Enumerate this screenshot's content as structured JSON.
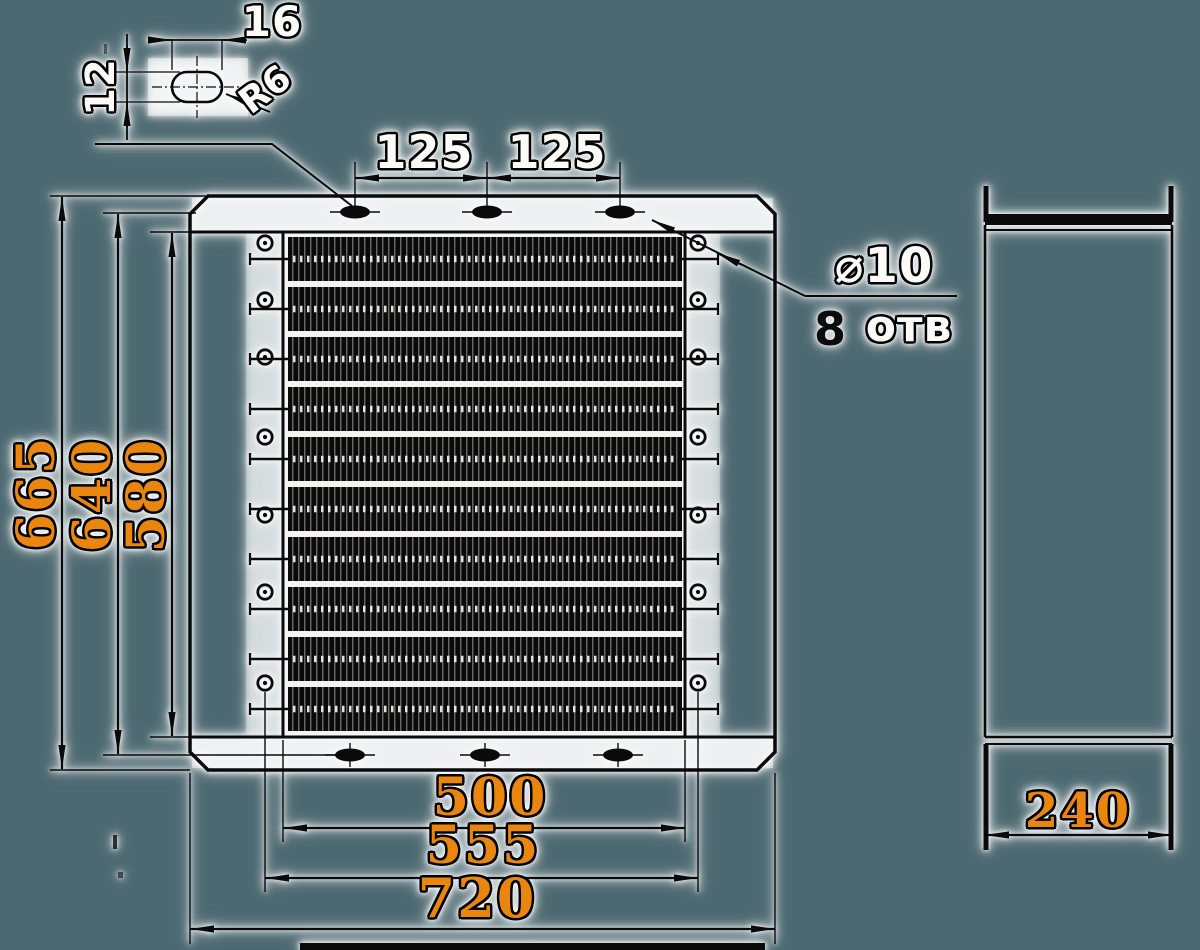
{
  "drawing_title": "finned-element heater frame, two-view dimensioned drawing",
  "colors": {
    "background": "#4c6870",
    "ink": "#0a0a0a",
    "accent_orange": "#ea860d",
    "paper_halo": "#f7f7f4"
  },
  "detail_slot": {
    "width": "16",
    "height": "12",
    "radius": "R6"
  },
  "top_pitch": {
    "left": "125",
    "right": "125"
  },
  "hole_note": {
    "diameter": "⌀10",
    "count": "8",
    "holes_word": "отв"
  },
  "height_dims": {
    "overall": "665",
    "slot_centers": "640",
    "frame_inner": "580"
  },
  "width_dims": {
    "element_span": "500",
    "terminal_span": "555",
    "overall": "720"
  },
  "side_view": {
    "depth": "240"
  }
}
